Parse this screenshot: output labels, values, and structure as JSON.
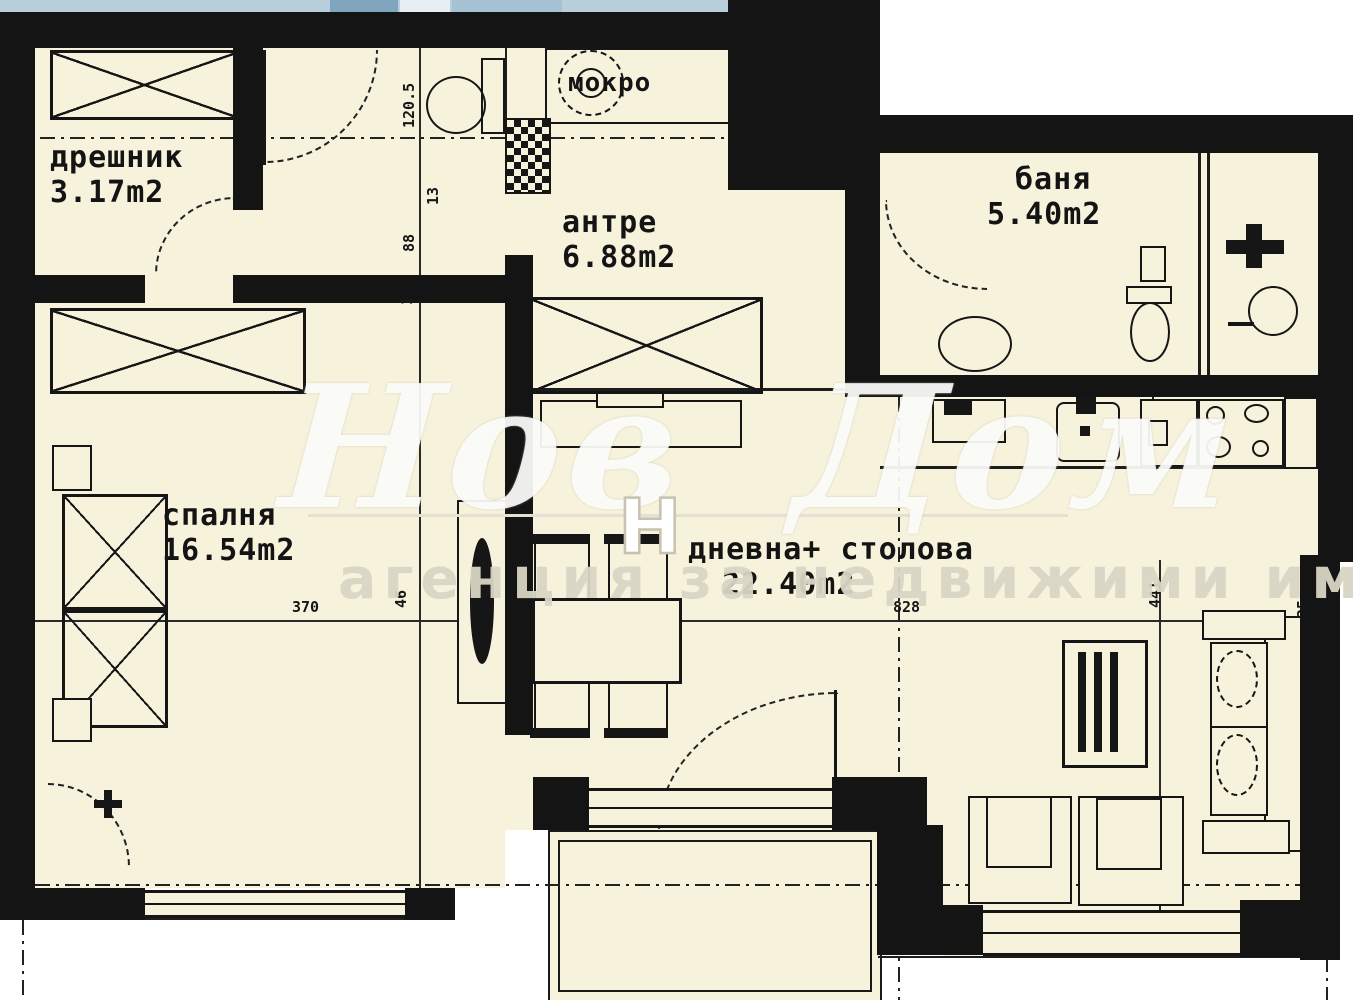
{
  "watermark": {
    "brand": "Нов Дом 1",
    "tagline": "агенция за недвижими имоти",
    "logo_letter": "Н"
  },
  "rooms": {
    "dreshnik": {
      "name": "дрешник",
      "area": "3.17m2"
    },
    "antre": {
      "name": "антре",
      "area": "6.88m2"
    },
    "banya": {
      "name": "баня",
      "area": "5.40m2"
    },
    "spalnya": {
      "name": "спалня",
      "area": "16.54m2"
    },
    "dnevna": {
      "name": "дневна+ столова",
      "area": "22.40m2"
    },
    "mokro": {
      "name": "мокро"
    }
  },
  "dims": {
    "d120": "120.5",
    "d13": "13",
    "d88": "88",
    "d12": "12",
    "d370": "370",
    "d46": "46",
    "d828": "828",
    "d441": "441",
    "d25": "25"
  },
  "colors": {
    "floor": "#f6f2dc",
    "wall": "#141414",
    "paper": "#ffffff",
    "top_strip": "#b9cedb",
    "watermark": "#e4e0d2"
  }
}
